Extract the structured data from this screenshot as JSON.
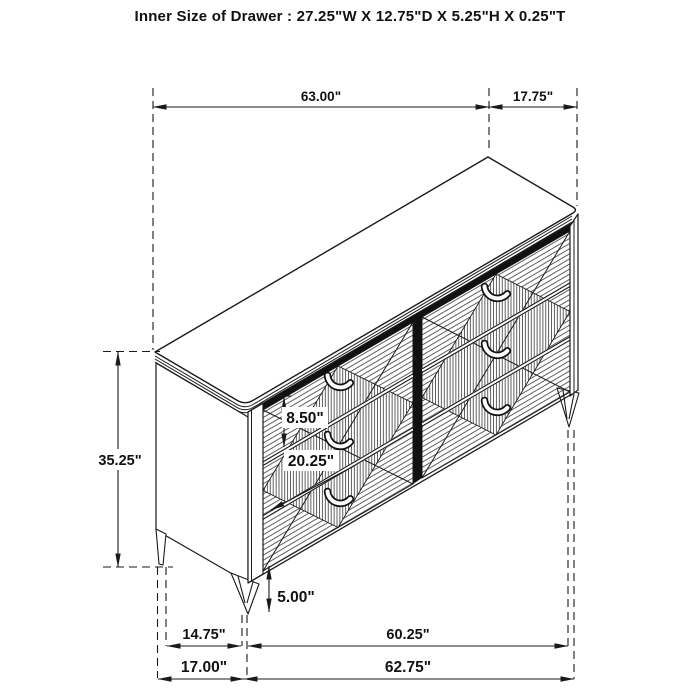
{
  "title": "Inner Size of Drawer : 27.25\"W X 12.75\"D X 5.25\"H X 0.25\"T",
  "diagram": {
    "type": "furniture-dimension-drawing",
    "item": "six-drawer-dresser-isometric",
    "labels": {
      "top_width": "63.00\"",
      "top_depth": "17.75\"",
      "overall_height": "35.25\"",
      "drawer_face_height": "8.50\"",
      "drawer_depth": "20.25\"",
      "leg_height": "5.00\"",
      "side_leg_spacing": "14.75\"",
      "front_leg_spacing": "60.25\"",
      "side_base_width": "17.00\"",
      "front_base_width": "62.75\""
    }
  },
  "colors": {
    "line": "#1a1a1a",
    "background": "#ffffff"
  }
}
